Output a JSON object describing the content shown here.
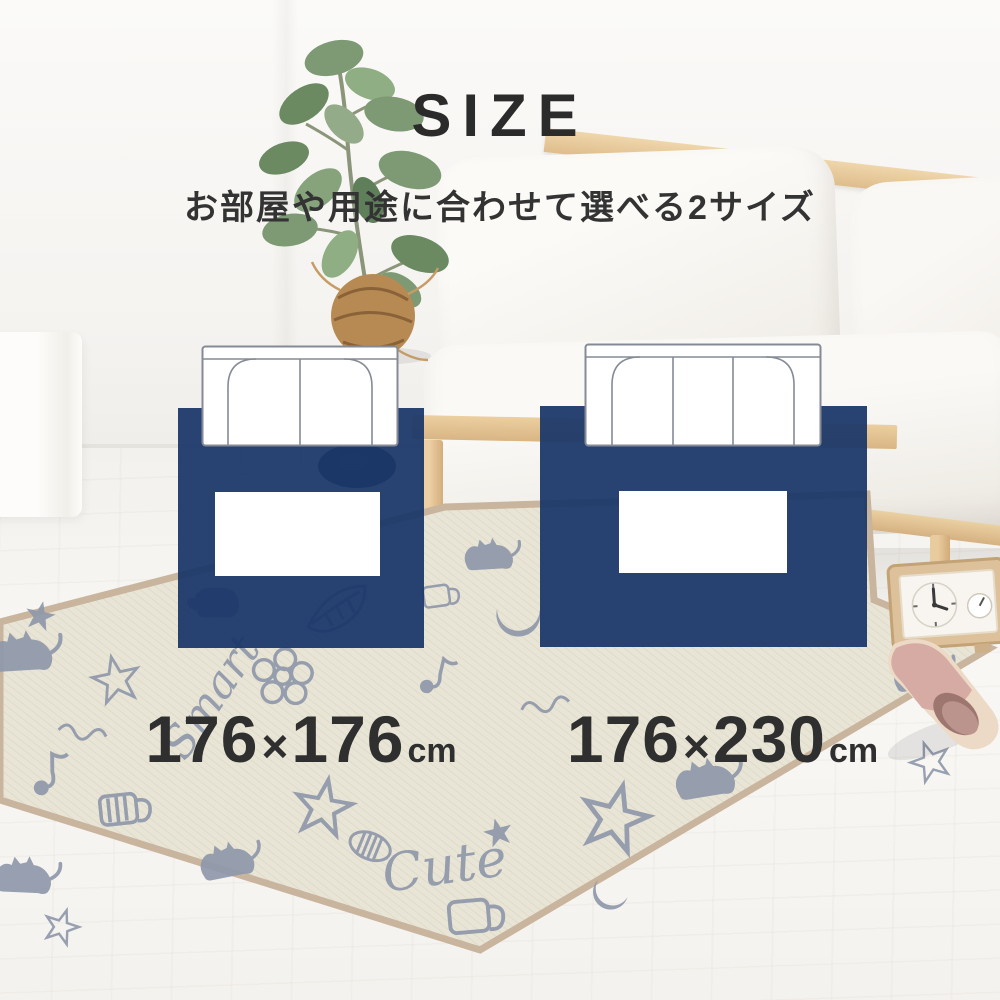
{
  "header": {
    "title": "SIZE",
    "subtitle": "お部屋や用途に合わせて選べる2サイズ"
  },
  "options": [
    {
      "name": "square-rug",
      "seats": 2,
      "size_a": "176",
      "times": "×",
      "size_b": "176",
      "unit": "cm"
    },
    {
      "name": "wide-rug",
      "seats": 3,
      "size_a": "176",
      "times": "×",
      "size_b": "230",
      "unit": "cm"
    }
  ],
  "scene": {
    "rug_words": {
      "smart": "Smart",
      "cute": "Cute"
    }
  },
  "colors": {
    "navy": "#1b3769",
    "ink": "#2b2b2b",
    "ink2": "#2f2f2f",
    "rug_base": "#e9e5d6",
    "rug_motif": "#8e98ab",
    "rug_border": "#c9b59d",
    "wood": "#e4c598",
    "sofa_white": "#f7f5f1",
    "slipper_pink": "#d6aba3",
    "plant_green": "#7d9a74",
    "fiber_brown": "#b68a52"
  }
}
